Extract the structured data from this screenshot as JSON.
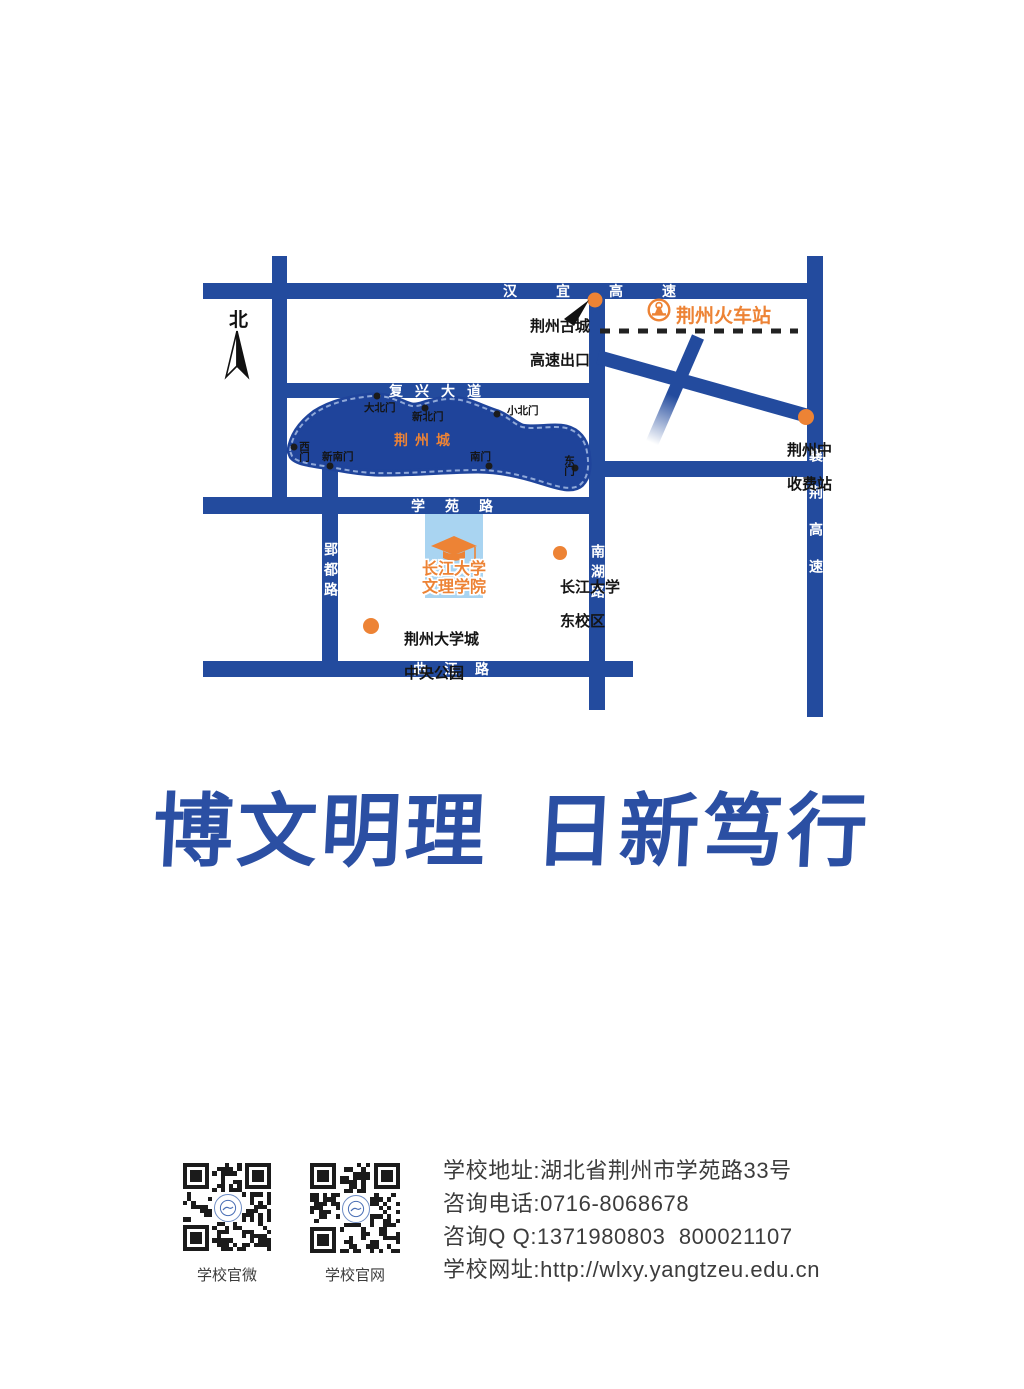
{
  "colors": {
    "road_blue": "#234B9E",
    "city_blue": "#1F449B",
    "wall_pattern": "#8FA8D8",
    "accent_orange": "#ED8335",
    "campus_light_blue": "#A9D4F1",
    "motto_blue": "#2B4FA3",
    "footer_text": "#3C3C3C",
    "railway_black": "#222222"
  },
  "icons": {
    "north_arrow": "compass-needle",
    "train_station_badge": "china-railway-badge",
    "college_marker": "graduation-cap",
    "poi_marker": "orange-dot",
    "gate_marker": "black-dot"
  },
  "map": {
    "compass": "北",
    "roads": {
      "hanyi": "汉宜高速",
      "fuxing": "复兴大道",
      "xueyuan": "学苑路",
      "qujiang": "曲江路",
      "yingdu": "郢都路",
      "nanhu": "南湖路",
      "xiangjing": "襄荆高速"
    },
    "city": {
      "name": "荆州城",
      "gates": {
        "dabeimen": "大北门",
        "xinbeimen": "新北门",
        "xiaobeimen": "小北门",
        "ximen": "西门",
        "xinnanmen": "新南门",
        "nanmen": "南门",
        "dongmen": "东门"
      }
    },
    "pois": {
      "exit_line1": "荆州古城",
      "exit_line2": "高速出口",
      "train_station": "荆州火车站",
      "toll_line1": "荆州中",
      "toll_line2": "收费站",
      "college_line1": "长江大学",
      "college_line2": "文理学院",
      "east_campus_line1": "长江大学",
      "east_campus_line2": "东校区",
      "park_line1": "荆州大学城",
      "park_line2": "中央公园"
    }
  },
  "motto": {
    "part1": "博文明理",
    "part2": "日新笃行"
  },
  "footer": {
    "qr_wechat_label": "学校官微",
    "qr_website_label": "学校官网",
    "contact_lines": [
      "学校地址:湖北省荆州市学苑路33号",
      "咨询电话:0716-8068678",
      "咨询Q Q:1371980803  800021107",
      "学校网址:http://wlxy.yangtzeu.edu.cn"
    ]
  }
}
